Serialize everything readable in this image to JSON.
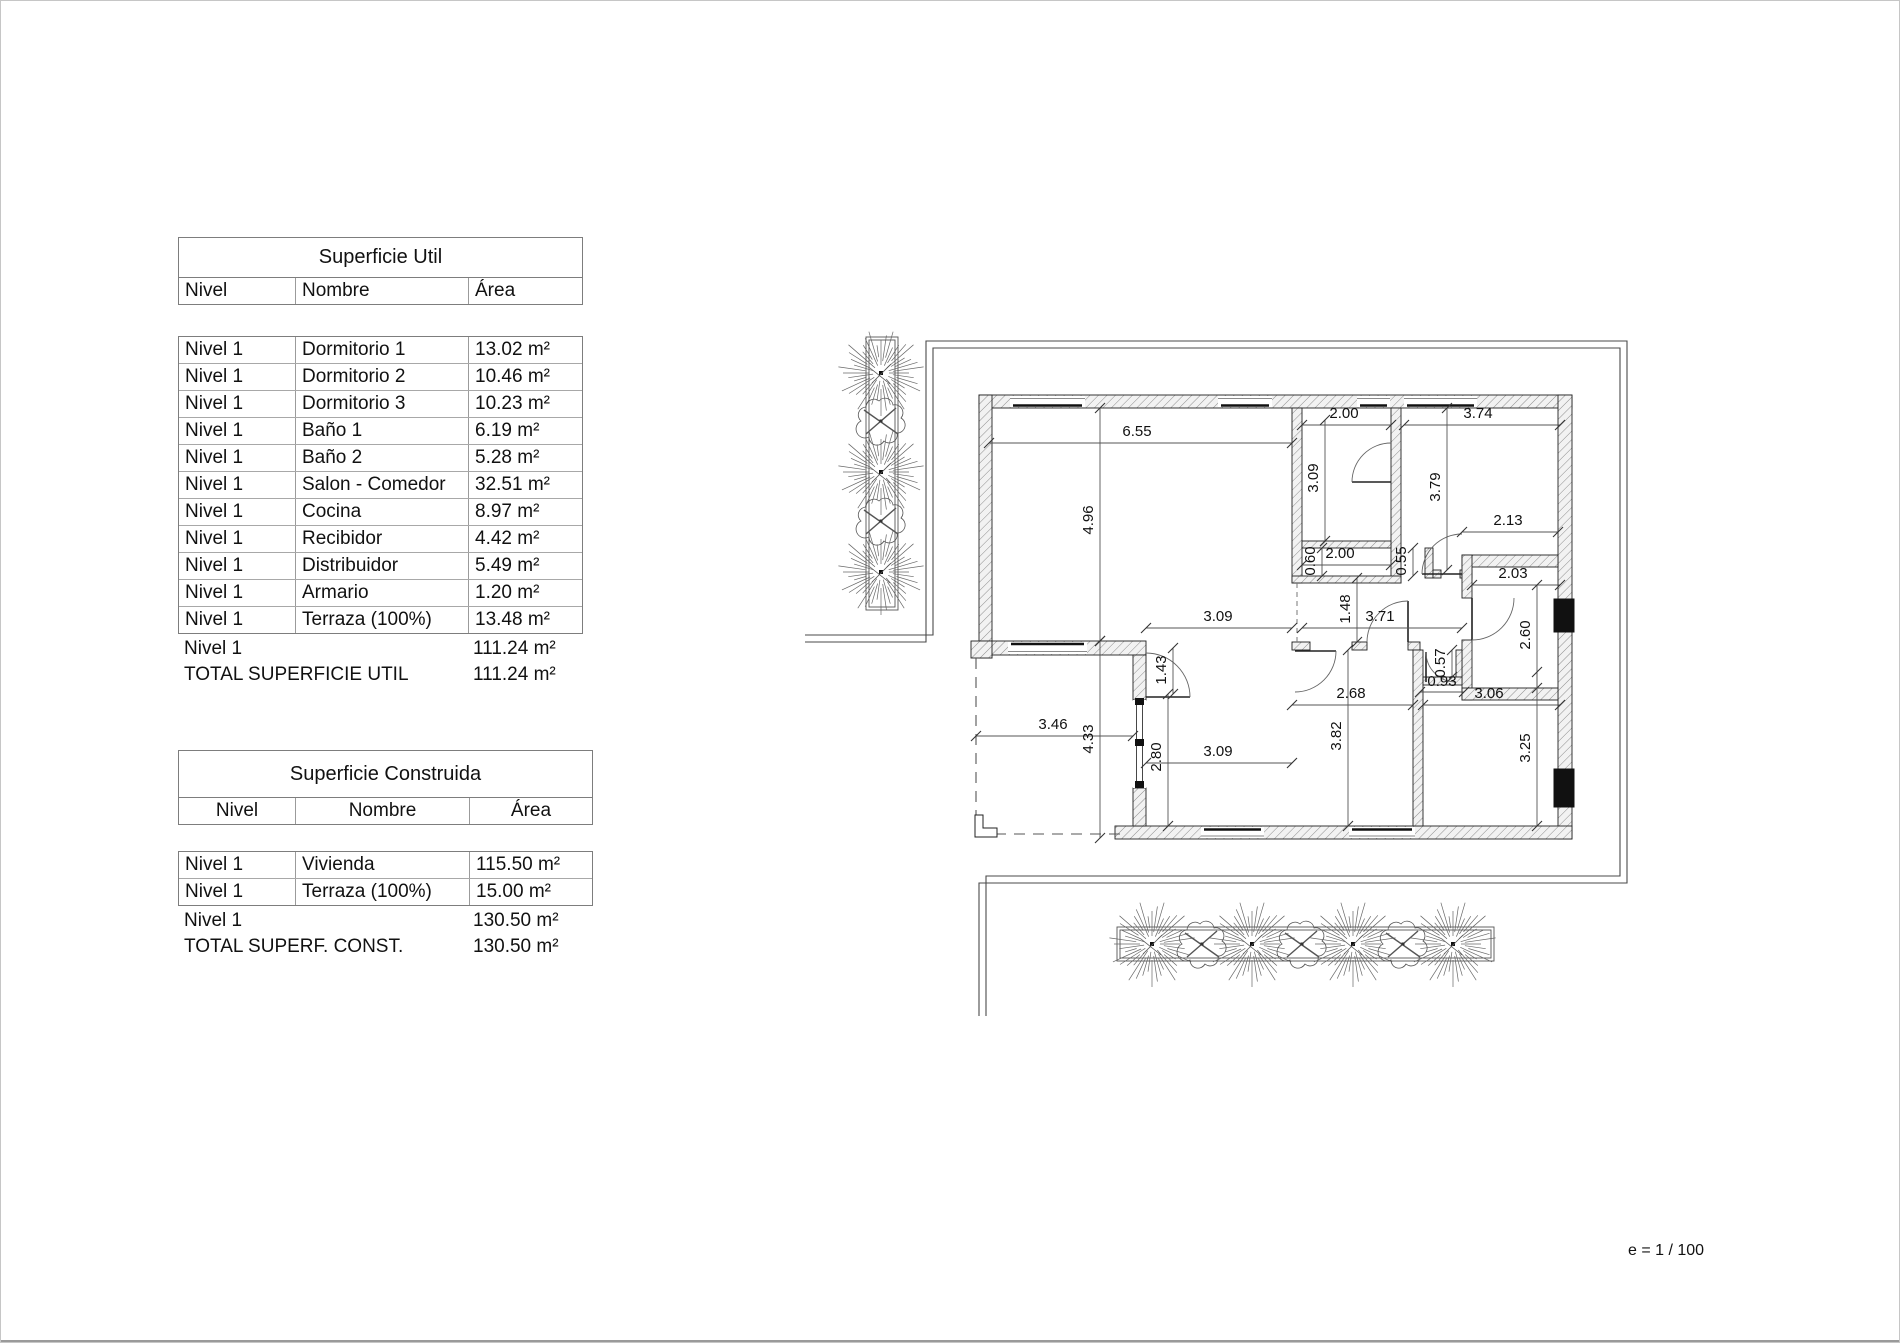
{
  "sheet": {
    "scale_note": "e = 1 / 100"
  },
  "superficie_util": {
    "title": "Superficie Util",
    "columns": {
      "nivel": "Nivel",
      "nombre": "Nombre",
      "area": "Área"
    },
    "rows": [
      {
        "nivel": "Nivel 1",
        "nombre": "Dormitorio 1",
        "area": "13.02 m²"
      },
      {
        "nivel": "Nivel 1",
        "nombre": "Dormitorio 2",
        "area": "10.46 m²"
      },
      {
        "nivel": "Nivel 1",
        "nombre": "Dormitorio 3",
        "area": "10.23 m²"
      },
      {
        "nivel": "Nivel 1",
        "nombre": "Baño 1",
        "area": "6.19 m²"
      },
      {
        "nivel": "Nivel 1",
        "nombre": "Baño 2",
        "area": "5.28 m²"
      },
      {
        "nivel": "Nivel 1",
        "nombre": "Salon - Comedor",
        "area": "32.51 m²"
      },
      {
        "nivel": "Nivel 1",
        "nombre": "Cocina",
        "area": "8.97 m²"
      },
      {
        "nivel": "Nivel 1",
        "nombre": "Recibidor",
        "area": "4.42 m²"
      },
      {
        "nivel": "Nivel 1",
        "nombre": "Distribuidor",
        "area": "5.49 m²"
      },
      {
        "nivel": "Nivel 1",
        "nombre": "Armario",
        "area": "1.20 m²"
      },
      {
        "nivel": "Nivel 1",
        "nombre": "Terraza (100%)",
        "area": "13.48 m²"
      }
    ],
    "subtotal": {
      "nivel": "Nivel 1",
      "area": "111.24 m²"
    },
    "total": {
      "label": "TOTAL SUPERFICIE UTIL",
      "area": "111.24 m²"
    }
  },
  "superficie_construida": {
    "title": "Superficie Construida",
    "columns": {
      "nivel": "Nivel",
      "nombre": "Nombre",
      "area": "Área"
    },
    "rows": [
      {
        "nivel": "Nivel 1",
        "nombre": "Vivienda",
        "area": "115.50 m²"
      },
      {
        "nivel": "Nivel 1",
        "nombre": "Terraza (100%)",
        "area": "15.00 m²"
      }
    ],
    "subtotal": {
      "nivel": "Nivel 1",
      "area": "130.50 m²"
    },
    "total": {
      "label": "TOTAL SUPERF. CONST.",
      "area": "130.50 m²"
    }
  },
  "floor_plan": {
    "dimensions": [
      {
        "text": "6.55",
        "x1": 989,
        "y1": 443,
        "x2": 1292,
        "y2": 443,
        "tx": 1137,
        "ty": 436,
        "rot": 0
      },
      {
        "text": "2.00",
        "x1": 1302,
        "y1": 425,
        "x2": 1391,
        "y2": 425,
        "tx": 1344,
        "ty": 418,
        "rot": 0
      },
      {
        "text": "3.74",
        "x1": 1404,
        "y1": 425,
        "x2": 1560,
        "y2": 425,
        "tx": 1478,
        "ty": 418,
        "rot": 0
      },
      {
        "text": "2.13",
        "x1": 1462,
        "y1": 532,
        "x2": 1558,
        "y2": 532,
        "tx": 1508,
        "ty": 525,
        "rot": 0
      },
      {
        "text": "2.00",
        "x1": 1302,
        "y1": 565,
        "x2": 1391,
        "y2": 565,
        "tx": 1340,
        "ty": 558,
        "rot": 0
      },
      {
        "text": "2.03",
        "x1": 1472,
        "y1": 585,
        "x2": 1560,
        "y2": 585,
        "tx": 1513,
        "ty": 578,
        "rot": 0
      },
      {
        "text": "3.09",
        "x1": 1146,
        "y1": 628,
        "x2": 1292,
        "y2": 628,
        "tx": 1218,
        "ty": 621,
        "rot": 0
      },
      {
        "text": "3.71",
        "x1": 1302,
        "y1": 628,
        "x2": 1462,
        "y2": 628,
        "tx": 1380,
        "ty": 621,
        "rot": 0
      },
      {
        "text": "0.93",
        "x1": 1420,
        "y1": 692,
        "x2": 1464,
        "y2": 692,
        "tx": 1442,
        "ty": 686,
        "rot": 0
      },
      {
        "text": "2.68",
        "x1": 1292,
        "y1": 705,
        "x2": 1413,
        "y2": 705,
        "tx": 1351,
        "ty": 698,
        "rot": 0
      },
      {
        "text": "3.06",
        "x1": 1423,
        "y1": 705,
        "x2": 1560,
        "y2": 705,
        "tx": 1489,
        "ty": 698,
        "rot": 0
      },
      {
        "text": "3.46",
        "x1": 976,
        "y1": 736,
        "x2": 1133,
        "y2": 736,
        "tx": 1053,
        "ty": 729,
        "rot": 0
      },
      {
        "text": "3.09",
        "x1": 1146,
        "y1": 763,
        "x2": 1292,
        "y2": 763,
        "tx": 1218,
        "ty": 756,
        "rot": 0
      },
      {
        "text": "4.96",
        "x1": 1100,
        "y1": 408,
        "x2": 1100,
        "y2": 641,
        "tx": 1093,
        "ty": 520,
        "rot": -90
      },
      {
        "text": "3.09",
        "x1": 1325,
        "y1": 420,
        "x2": 1325,
        "y2": 541,
        "tx": 1318,
        "ty": 478,
        "rot": -90
      },
      {
        "text": "3.79",
        "x1": 1447,
        "y1": 408,
        "x2": 1447,
        "y2": 570,
        "tx": 1440,
        "ty": 487,
        "rot": -90
      },
      {
        "text": "0.60",
        "x1": 1322,
        "y1": 548,
        "x2": 1322,
        "y2": 576,
        "tx": 1315,
        "ty": 561,
        "rot": -90
      },
      {
        "text": "0.55",
        "x1": 1413,
        "y1": 548,
        "x2": 1413,
        "y2": 576,
        "tx": 1406,
        "ty": 561,
        "rot": -90
      },
      {
        "text": "1.48",
        "x1": 1357,
        "y1": 578,
        "x2": 1357,
        "y2": 642,
        "tx": 1350,
        "ty": 609,
        "rot": -90
      },
      {
        "text": "2.60",
        "x1": 1537,
        "y1": 585,
        "x2": 1537,
        "y2": 688,
        "tx": 1530,
        "ty": 635,
        "rot": -90
      },
      {
        "text": "1.43",
        "x1": 1173,
        "y1": 648,
        "x2": 1173,
        "y2": 694,
        "tx": 1166,
        "ty": 670,
        "rot": -90
      },
      {
        "text": "0.57",
        "x1": 1452,
        "y1": 650,
        "x2": 1452,
        "y2": 677,
        "tx": 1445,
        "ty": 663,
        "rot": -90
      },
      {
        "text": "4.33",
        "x1": 1100,
        "y1": 641,
        "x2": 1100,
        "y2": 838,
        "tx": 1093,
        "ty": 739,
        "rot": -90
      },
      {
        "text": "2.80",
        "x1": 1168,
        "y1": 694,
        "x2": 1168,
        "y2": 826,
        "tx": 1161,
        "ty": 757,
        "rot": -90
      },
      {
        "text": "3.82",
        "x1": 1348,
        "y1": 650,
        "x2": 1348,
        "y2": 826,
        "tx": 1341,
        "ty": 736,
        "rot": -90
      },
      {
        "text": "3.25",
        "x1": 1537,
        "y1": 672,
        "x2": 1537,
        "y2": 826,
        "tx": 1530,
        "ty": 748,
        "rot": -90
      }
    ]
  }
}
